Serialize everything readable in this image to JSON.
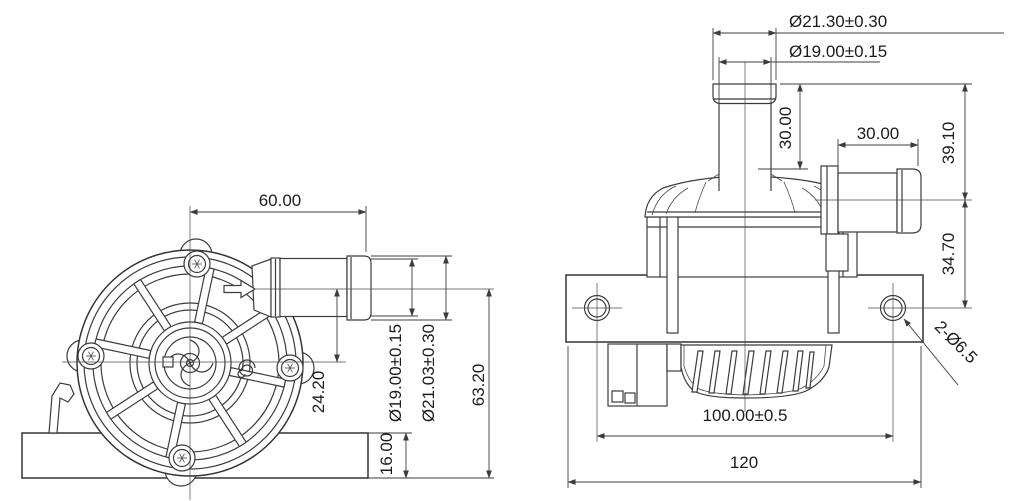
{
  "drawing_type": "pump-engineering-drawing",
  "front_view": {
    "width": "60.00",
    "axis_offset": "24.20",
    "outlet_inner_dia": "Ø19.00±0.15",
    "outlet_outer_dia": "Ø21.03±0.30",
    "total_height": "63.20",
    "bracket_thickness": "16.00"
  },
  "side_view": {
    "inlet_outer_dia": "Ø21.30±0.30",
    "inlet_inner_dia": "Ø19.00±0.15",
    "inlet_height": "30.00",
    "outlet_length": "30.00",
    "inlet_to_outlet_axis": "39.10",
    "outlet_axis_to_mount": "34.70",
    "mount_holes": "2-Ø6.5",
    "hole_spacing": "100.00±0.5",
    "overall_width": "120"
  },
  "colors": {
    "line": "#3c3c3c",
    "text": "#1c1c1c",
    "background": "#ffffff"
  }
}
